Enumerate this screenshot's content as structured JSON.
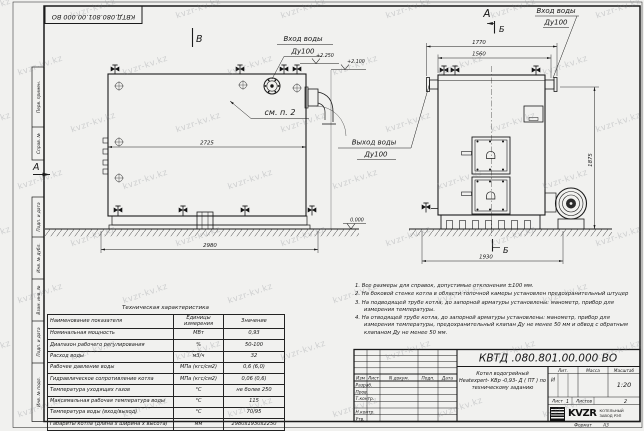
{
  "watermark": "kvzr-kv.kz",
  "stamp_top": "КВТД.080.801.00.000 ВО",
  "frame_labels": {
    "perv": "Перв. примен.",
    "sprav": "Справ. №",
    "podp1": "Подп. и дата",
    "inv_dubl": "Инв. № дубл.",
    "vzam": "Взам. инв. №",
    "podp2": "Подп. и дата",
    "inv_podl": "Инв. № подл."
  },
  "side_view": {
    "marker": "В",
    "section_a": "А",
    "inlet_line1": "Вход воды",
    "inlet_line2": "Ду100",
    "see_item": "см. п. 2",
    "dim_inner": "2725",
    "dim_outer": "2980",
    "elev_top1": "+2.250",
    "elev_top2": "+2.100",
    "elev_zero": "0.000"
  },
  "front_view": {
    "marker": "А",
    "section_b_top": "Б",
    "section_b_bottom": "Б",
    "inlet_line1": "Вход воды",
    "inlet_line2": "Ду100",
    "outlet_line1": "Выход воды",
    "outlet_line2": "Ду100",
    "dim_top_outer": "1770",
    "dim_top_inner": "1560",
    "dim_side": "1875",
    "dim_bottom": "1930"
  },
  "notes": {
    "line1": "1. Все размеры для справок, допустимые отклонения ±100 мм.",
    "line2": "2. На боковой стенке котла в области топочной камеры установлен предохранительный штуцер",
    "line3": "3. На подводящей трубе котла, до запорной арматуры установлены: манометр, прибор для измерения температуры.",
    "line4": "4. На отводящей трубе котла, до запорной арматуры установлены: манометр, прибор для измерения температуры, предохранительный клапан Ду не менее 50 мм и обвод с обратным клапаном Ду не менее 50 мм."
  },
  "tech_table": {
    "title": "Техническая характеристика",
    "col_name": "Наименование показателя",
    "col_unit": "Единицы измерения",
    "col_value": "Значение",
    "rows": [
      {
        "name": "Номинальная мощность",
        "unit": "МВт",
        "value": "0,93"
      },
      {
        "name": "Диапазон рабочего регулирования",
        "unit": "%",
        "value": "50-100"
      },
      {
        "name": "Расход воды",
        "unit": "м3/ч",
        "value": "32"
      },
      {
        "name": "Рабочее давление воды",
        "unit": "МПа (кгс/см2)",
        "value": "0,6 (6,0)"
      },
      {
        "name": "Гидравлическое сопротивление котла",
        "unit": "МПа (кгс/см2)",
        "value": "0,06 (0,6)"
      },
      {
        "name": "Температура уходящих газов",
        "unit": "°С",
        "value": "не более 250"
      },
      {
        "name": "Максимальная рабочая температура воды",
        "unit": "°С",
        "value": "115"
      },
      {
        "name": "Температура воды (вход/выход)",
        "unit": "°С",
        "value": "70/95"
      },
      {
        "name": "Габариты котла (длина х ширина х высота)",
        "unit": "мм",
        "value": "2980х1930х2250"
      }
    ]
  },
  "title_block": {
    "doc_number": "КВТД .080.801.00.000  ВО",
    "desc_line1": "Котел водогрейный",
    "desc_line2": "Heatexpert- КВр -0,93- Д ( ПТ )  по",
    "desc_line3": "техническому заданию",
    "col_izm": "Изм",
    "col_list": "Лист",
    "col_ndoc": "N докум.",
    "col_podp": "Подп.",
    "col_data": "Дата",
    "row_razrab": "Разраб.",
    "row_prov": "Пров.",
    "row_tkontr": "Т.контр.",
    "row_nkontr": "Н.контр.",
    "row_utv": "Утв.",
    "lit_label": "Лит.",
    "lit_value": "И",
    "mass_label": "Масса",
    "scale_label": "Масштаб",
    "scale_value": "1:20",
    "sheet_label": "Лист",
    "sheet_value": "1",
    "sheets_label": "Листов",
    "sheets_value": "2",
    "logo_text": "KVZR",
    "logo_cap1": "КОТЕЛЬНЫЙ",
    "logo_cap2": "ЗАВОД РЭП",
    "format_label": "Формат",
    "format_value": "А3"
  }
}
